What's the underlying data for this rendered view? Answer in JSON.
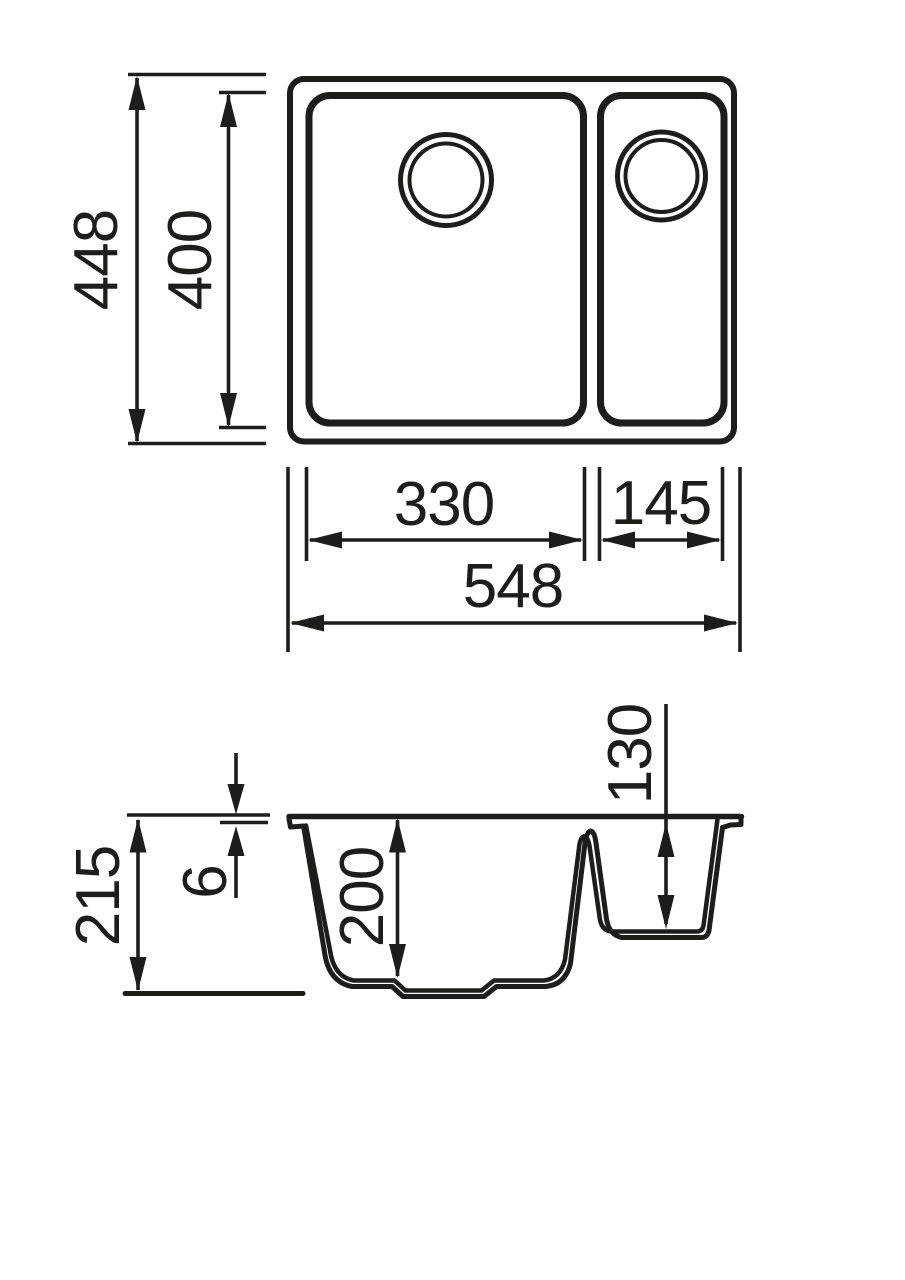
{
  "drawing": {
    "type": "technical-dimension-drawing",
    "subject": "one-and-a-half-bowl-sink",
    "colors": {
      "line": "#1d1d1b",
      "background": "#ffffff"
    },
    "plan_view": {
      "dims": {
        "overall_depth": "448",
        "bowl_depth": "400",
        "main_bowl_width": "330",
        "half_bowl_width": "145",
        "overall_width": "548"
      }
    },
    "section_view": {
      "dims": {
        "overall_height": "215",
        "rim_thickness": "6",
        "main_bowl_depth": "200",
        "half_bowl_depth": "130"
      }
    }
  }
}
